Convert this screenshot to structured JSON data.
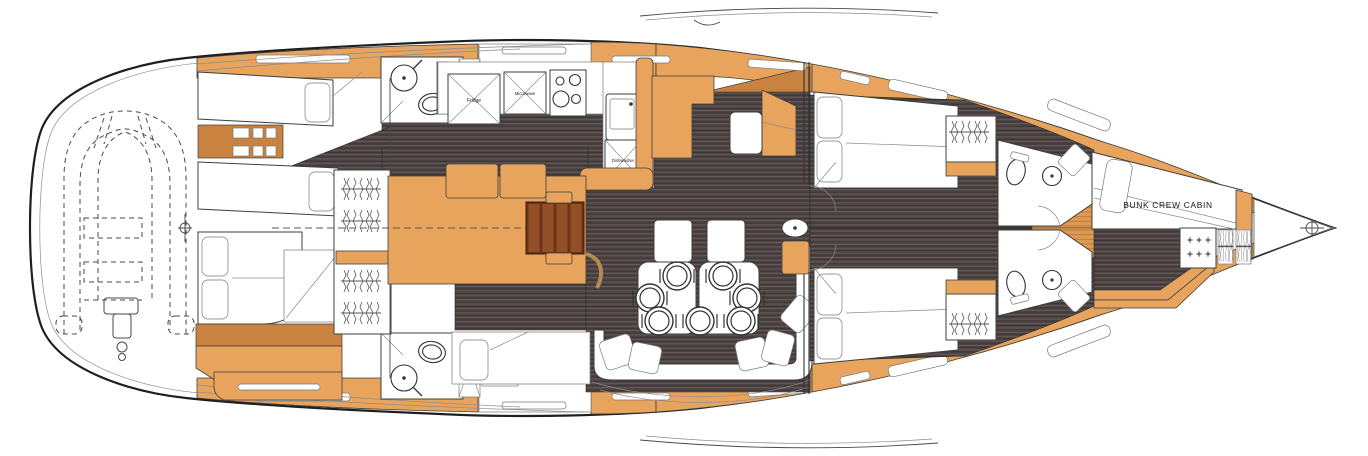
{
  "labels": {
    "fridge": "Fridge",
    "microwave": "Microwave",
    "dishwasher": "Dishwasher",
    "bunk_crew_cabin": "BUNK CREW CABIN"
  },
  "palette": {
    "deck_orange": "#E8A45C",
    "shelf_orange": "#C9823F",
    "teak_light": "#DD9A55",
    "teak_stripe": "#BC7D38",
    "floor_dark": "#4C4343",
    "floor_stripe": "#665A5A",
    "stair_brown": "#7C3A1C",
    "stair_slat": "#935028",
    "outline": "#2B2B2B",
    "white": "#FFFFFF"
  }
}
